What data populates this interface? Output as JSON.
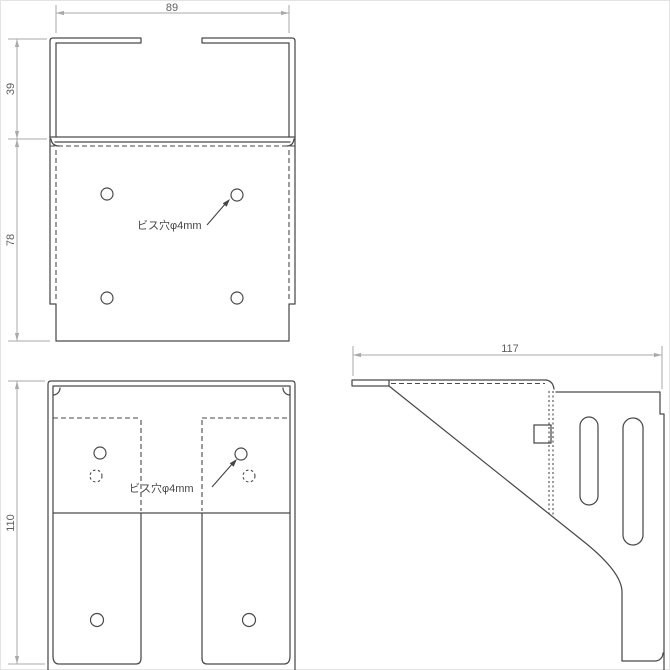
{
  "drawing": {
    "views": {
      "top": {
        "width_mm": "89",
        "flange_depth_mm": "39",
        "plate_depth_mm": "78",
        "hole_note": "ビス穴φ4mm"
      },
      "front": {
        "height_mm": "110",
        "hole_note": "ビス穴φ4mm"
      },
      "side": {
        "depth_mm": "117"
      }
    },
    "colors": {
      "background": "#ffffff",
      "part_line": "#4a4a4a",
      "dimension_line": "#a9a9a9",
      "dimension_text": "#5f5f5f"
    }
  }
}
